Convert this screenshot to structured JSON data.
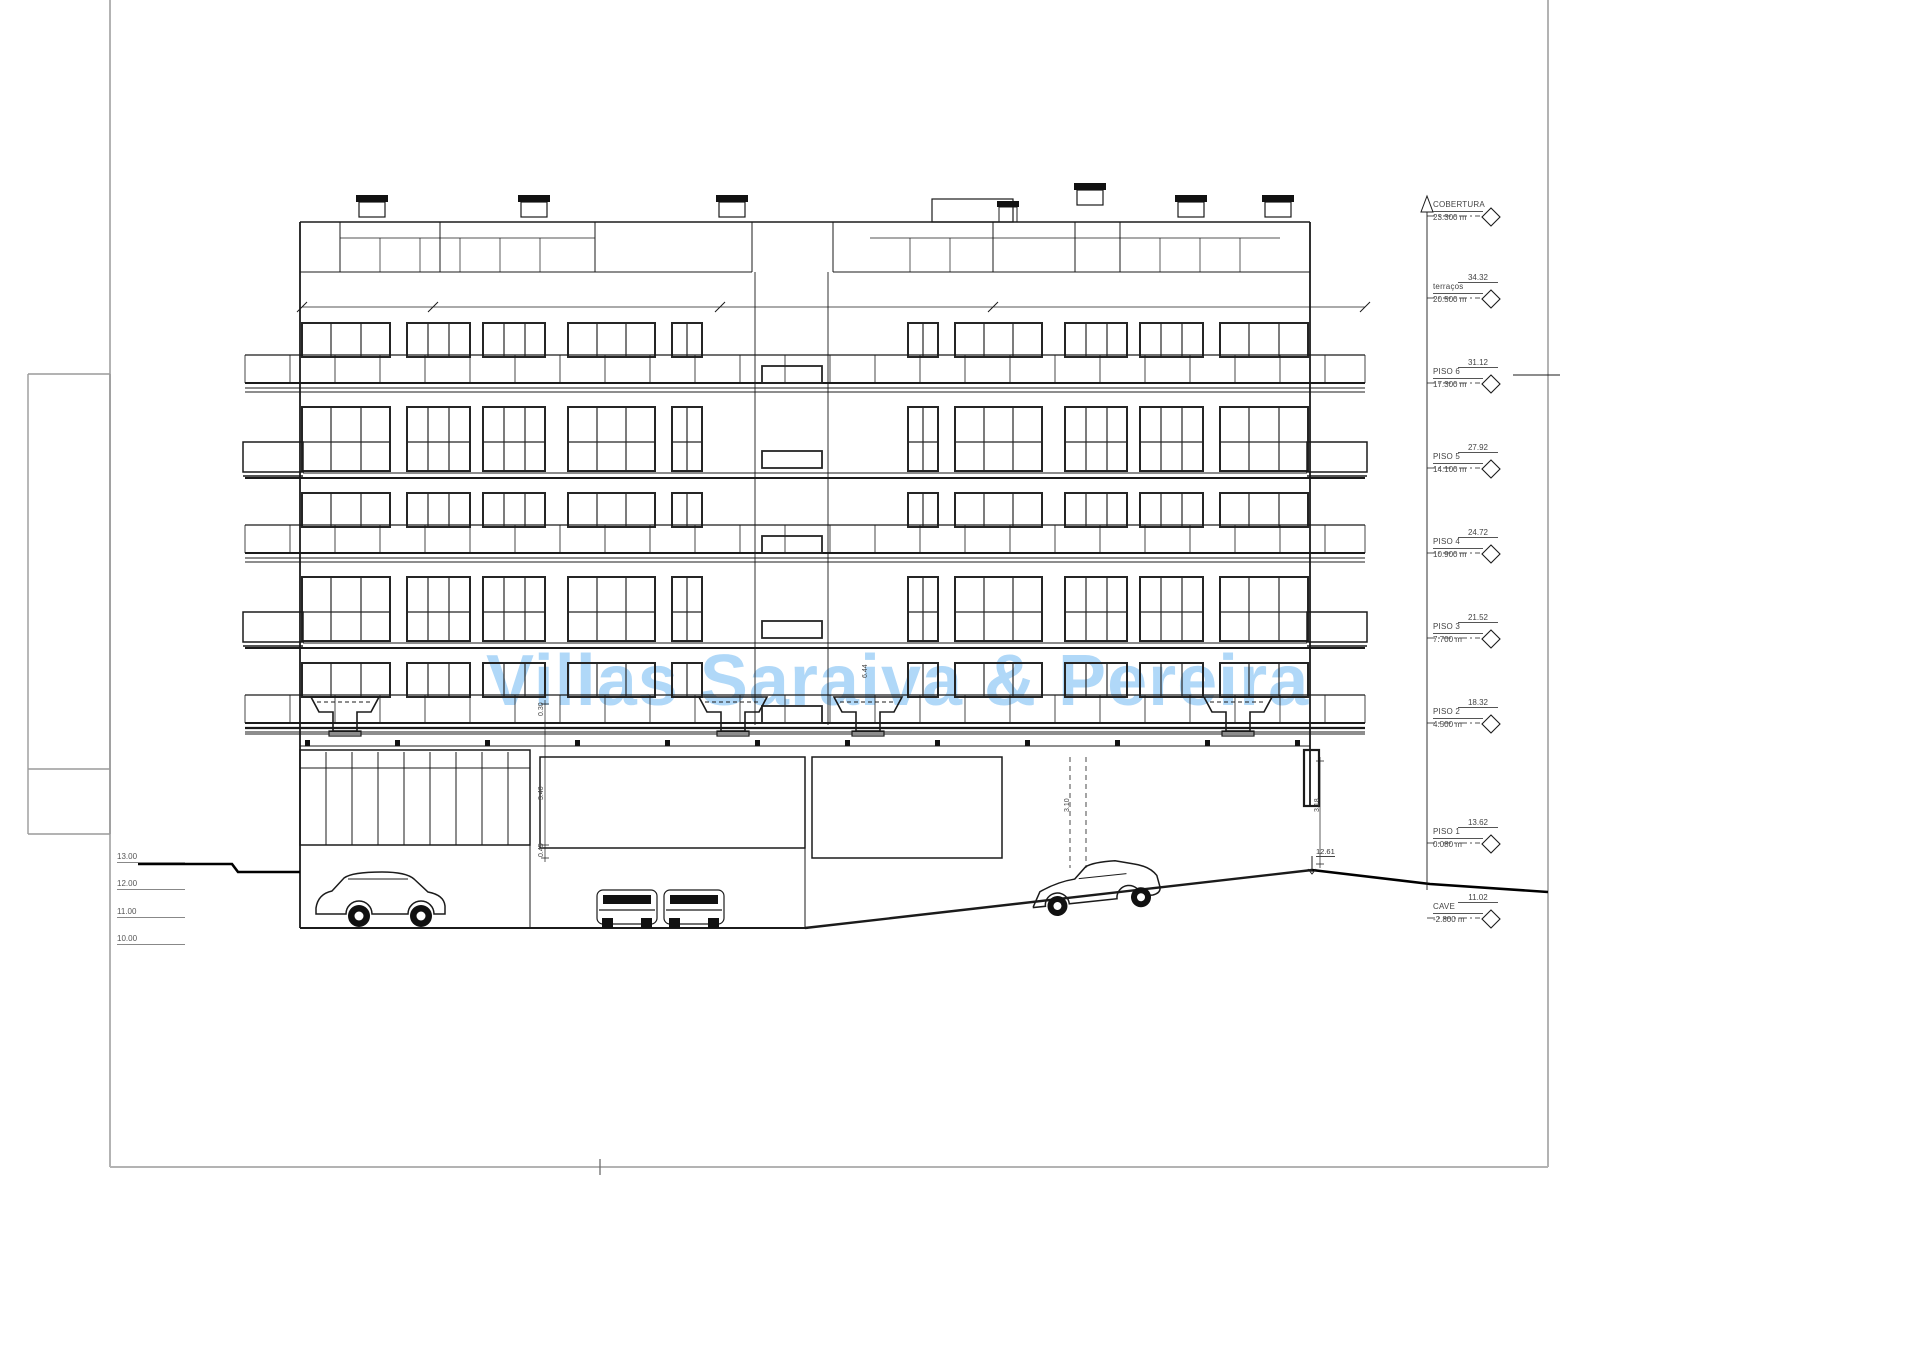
{
  "page": {
    "background": "#ffffff",
    "watermark_color": "#b0d8f8"
  },
  "watermark": {
    "text": "Villas Saraiva & Pereira"
  },
  "level_markers": [
    {
      "name": "COBERTURA",
      "elevation": "23.300 m",
      "absolute": ""
    },
    {
      "name": "terraços",
      "elevation": "20.500 m",
      "absolute": "34.32"
    },
    {
      "name": "PISO 6",
      "elevation": "17.300 m",
      "absolute": "31.12"
    },
    {
      "name": "PISO 5",
      "elevation": "14.100 m",
      "absolute": "27.92"
    },
    {
      "name": "PISO 4",
      "elevation": "10.900 m",
      "absolute": "24.72"
    },
    {
      "name": "PISO 3",
      "elevation": "7.700 m",
      "absolute": "21.52"
    },
    {
      "name": "PISO 2",
      "elevation": "4.500 m",
      "absolute": "18.32"
    },
    {
      "name": "PISO 1",
      "elevation": "0.080 m",
      "absolute": "13.62"
    },
    {
      "name": "CAVE",
      "elevation": "-2.800 m",
      "absolute": "11.02"
    }
  ],
  "ground_elevations": [
    "13.00",
    "12.00",
    "11.00",
    "10.00"
  ],
  "spot_elevation": "12.61",
  "dimension_labels": {
    "d1": "0.30",
    "d2": "3.40",
    "d3": "0.45",
    "d4": "6.44",
    "d5": "3.10",
    "d6": "3.18"
  }
}
